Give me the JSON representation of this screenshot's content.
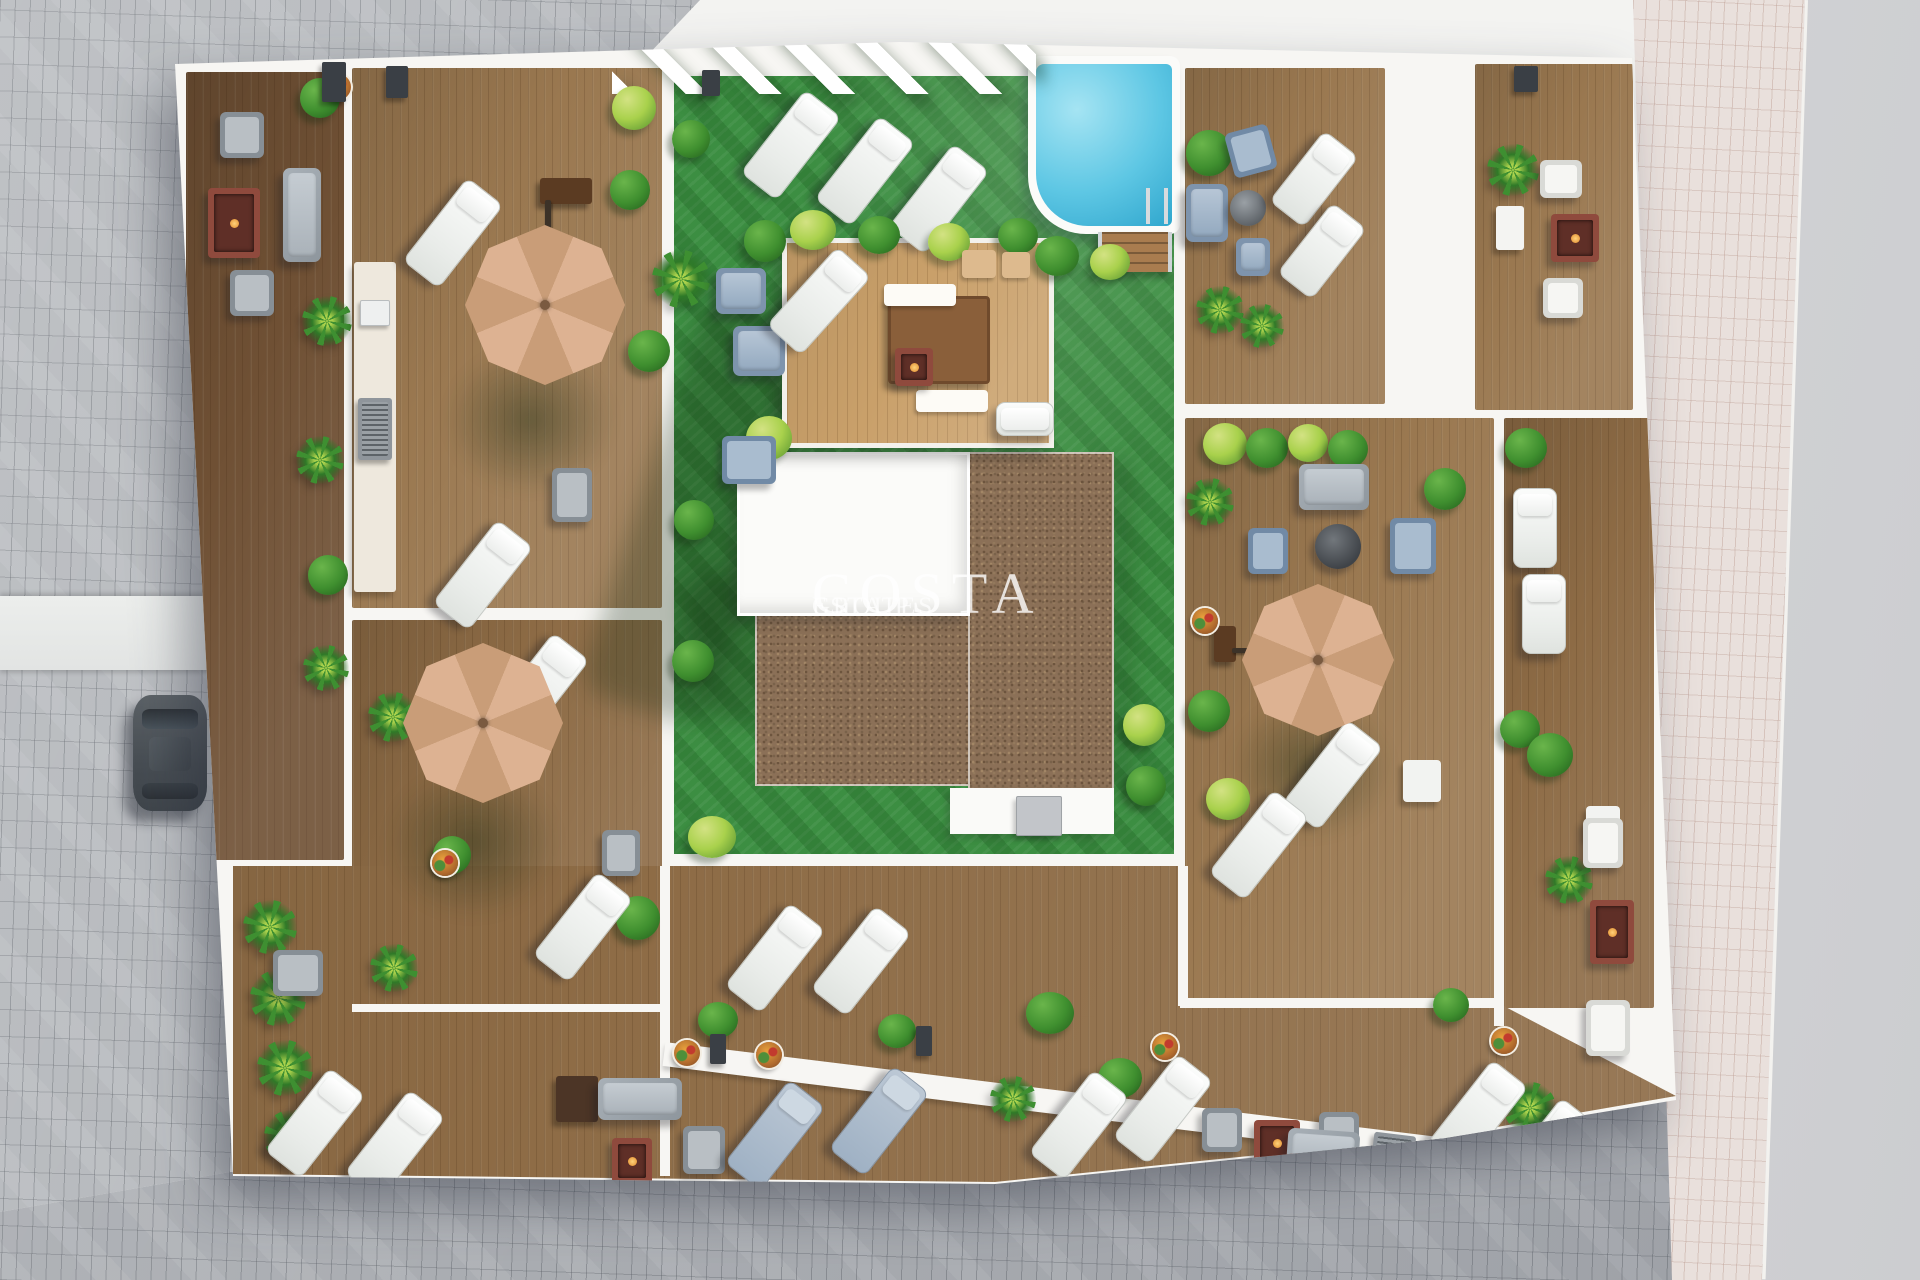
{
  "scene": {
    "type": "3d-architectural-render",
    "view": "aerial-top-down",
    "subject": "apartment building rooftop terraces with communal garden, swimming pool, lounge decks and parasols"
  },
  "watermark": {
    "brand": "COSTA",
    "sub1": "GROUP",
    "sub2": "ESTATES"
  },
  "palette": {
    "lawn": "#3c8e42",
    "pool_water": "#5ec7e4",
    "deck_light": "#9a7850",
    "deck_medium": "#8d6b45",
    "deck_dark": "#6f5034",
    "platform": "#c9a06a",
    "gravel": "#8b7057",
    "roof_white": "#fbfbf9",
    "paver_gray": "#b3b6ba",
    "paver_pink": "#e9e0dc",
    "road": "#d0d1d3",
    "umbrella": "#d7ac8b",
    "railing": "#f7f6f3",
    "plant_dark": "#3f8f2f",
    "plant_light": "#a9d14c",
    "fire_table": "#8f4a3d",
    "sofa_gray": "#97a0a8",
    "chair_blue": "#8fa6c2",
    "lounger": "#f4f6f4",
    "car": "#555b60"
  },
  "inventory": {
    "umbrellas": 3,
    "sun_loungers": 25,
    "sofas": 5,
    "armchairs": 15,
    "fire_tables": 6,
    "flower_pots": 7,
    "plants": 45,
    "pools": 1,
    "cars": 1
  }
}
